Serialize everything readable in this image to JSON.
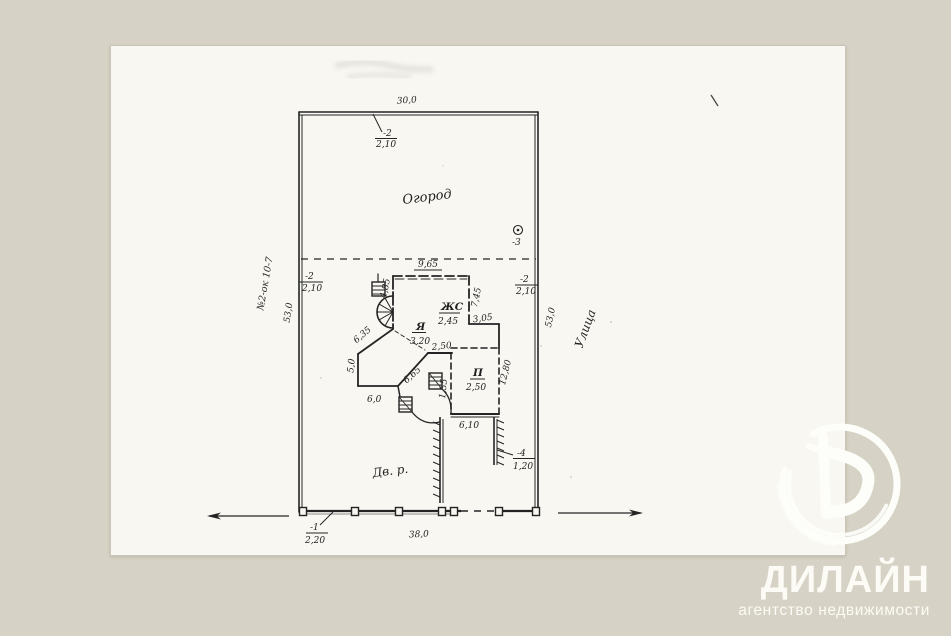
{
  "colors": {
    "background": "#d6d2c5",
    "paper": "#f8f7f2",
    "ink": "#242424",
    "logo_text": "#fcfbf5"
  },
  "branding": {
    "name": "ДИЛАЙН",
    "tagline": "агентство недвижимости",
    "monogram": "brush-circle-D"
  },
  "labels": [
    {
      "id": "top-width",
      "text": "30,0"
    },
    {
      "id": "gate-top-ref",
      "text": "-2"
    },
    {
      "id": "gate-top-size",
      "text": "2,10"
    },
    {
      "id": "garden",
      "text": "Огород"
    },
    {
      "id": "point-3-ref",
      "text": "-3"
    },
    {
      "id": "building-top-width",
      "text": "9,65"
    },
    {
      "id": "gate-left-ref",
      "text": "-2"
    },
    {
      "id": "gate-left-size",
      "text": "2,10"
    },
    {
      "id": "gate-right-ref",
      "text": "-2"
    },
    {
      "id": "gate-right-size",
      "text": "2,10"
    },
    {
      "id": "left-depth",
      "text": "53,0"
    },
    {
      "id": "left-note",
      "text": "№2-ок 10-7"
    },
    {
      "id": "right-depth",
      "text": "53,0"
    },
    {
      "id": "street",
      "text": "Улица"
    },
    {
      "id": "dim-4-85",
      "text": "4,85"
    },
    {
      "id": "dim-7-45",
      "text": "7,45"
    },
    {
      "id": "room-zhs",
      "text": "ЖС"
    },
    {
      "id": "room-zhs-val",
      "text": "2,45"
    },
    {
      "id": "room-ya",
      "text": "Я"
    },
    {
      "id": "room-ya-val",
      "text": "3,20"
    },
    {
      "id": "dim-3-05",
      "text": "3,05"
    },
    {
      "id": "dim-6-35",
      "text": "6,35"
    },
    {
      "id": "dim-5-0",
      "text": "5,0"
    },
    {
      "id": "dim-6-0",
      "text": "6,0"
    },
    {
      "id": "dim-6-65",
      "text": "6,65"
    },
    {
      "id": "dim-2-50-wall",
      "text": "2,50"
    },
    {
      "id": "dim-1-35",
      "text": "1,35"
    },
    {
      "id": "room-p",
      "text": "П"
    },
    {
      "id": "room-p-val",
      "text": "2,50"
    },
    {
      "id": "dim-12-80",
      "text": "12,80"
    },
    {
      "id": "dim-6-10",
      "text": "6,10"
    },
    {
      "id": "ref-4",
      "text": "-4"
    },
    {
      "id": "ref-4-size",
      "text": "1,20"
    },
    {
      "id": "yard",
      "text": "Дв. р."
    },
    {
      "id": "gate-bottom-ref",
      "text": "-1"
    },
    {
      "id": "gate-bottom-size",
      "text": "2,20"
    },
    {
      "id": "bottom-width",
      "text": "38,0"
    }
  ]
}
